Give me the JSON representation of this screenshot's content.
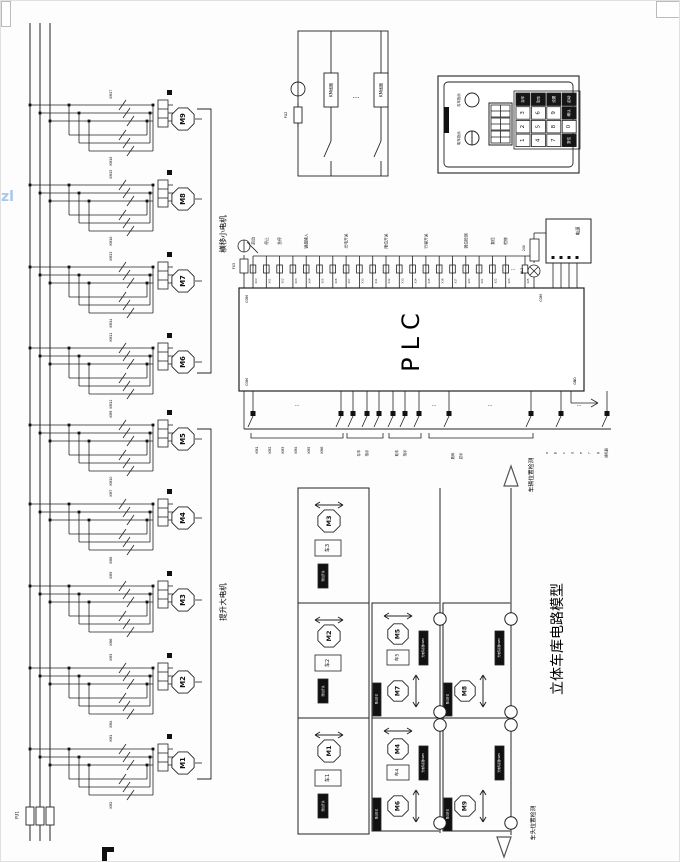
{
  "page": {
    "watermark": "zl"
  },
  "dots": "···",
  "power": {
    "fuse_main": "FU1"
  },
  "coil_box": {
    "fuse": "FU2",
    "lamp": "HL",
    "coil1": "KM线圈",
    "coil2": "KM线圈"
  },
  "panel": {
    "indicators": [
      {
        "label": "存车指示"
      },
      {
        "label": "取车指示"
      }
    ],
    "keys": [
      [
        "存车",
        "取车",
        "设置",
        "启动"
      ],
      [
        "3",
        "6",
        "9",
        "确认"
      ],
      [
        "2",
        "5",
        "8",
        "0"
      ],
      [
        "1",
        "4",
        "7",
        "复位"
      ]
    ]
  },
  "plc": {
    "label": "PLC",
    "com_tl": "COM",
    "com_tr": "COM",
    "com_bl": "COM",
    "gnd": "GND",
    "left_fuse": "FU3",
    "power_box": {
      "label": "电源",
      "rail_label": "24V",
      "lamp": "HL2"
    },
    "inputs": {
      "terminals": [
        "X00",
        "X01",
        "X02",
        "X03",
        "X04",
        "X05",
        "X06",
        "X07",
        "X10",
        "X11",
        "X12",
        "X13",
        "X14",
        "X15",
        "X16",
        "X17",
        "X20",
        "X21",
        "X22",
        "X23"
      ],
      "extra_terminal": "X25",
      "groups": [
        {
          "label": "启动",
          "at": 0
        },
        {
          "label": "停止",
          "at": 1
        },
        {
          "label": "急停",
          "at": 2
        },
        {
          "label": "键盘输入",
          "at": 4
        },
        {
          "label": "光电开关",
          "at": 7
        },
        {
          "label": "限位开关",
          "at": 10
        },
        {
          "label": "行程开关",
          "at": 13
        },
        {
          "label": "到位检测",
          "at": 16
        },
        {
          "label": "复位",
          "at": 18
        },
        {
          "label": "检修",
          "at": 19
        }
      ]
    },
    "outputs": {
      "coil_labels": [
        "KM1",
        "KM2",
        "KM3",
        "KM4",
        "KM5",
        "KM6"
      ],
      "group2": [
        "存车",
        "指示"
      ],
      "group3": [
        "取车",
        "指示"
      ],
      "group4": [
        "数码",
        "显示"
      ],
      "seg_labels": [
        "a",
        "b",
        "c",
        "d",
        "e",
        "f",
        "g",
        "蜂鸣器"
      ]
    }
  },
  "motor_section": {
    "branches": [
      {
        "name": "M1",
        "km_a": "KM1",
        "km_b": "KM2"
      },
      {
        "name": "M2",
        "km_a": "KM3",
        "km_b": "KM4"
      },
      {
        "name": "M3",
        "km_a": "KM5",
        "km_b": "KM6"
      },
      {
        "name": "M4",
        "km_a": "KM7",
        "km_b": "KM8"
      },
      {
        "name": "M5",
        "km_a": "KM9",
        "km_b": "KM10"
      },
      {
        "name": "M6",
        "km_a": "KM11",
        "km_b": "KM12"
      },
      {
        "name": "M7",
        "km_a": "KM13",
        "km_b": "KM14"
      },
      {
        "name": "M8",
        "km_a": "KM15",
        "km_b": "KM16"
      },
      {
        "name": "M9",
        "km_a": "KM17",
        "km_b": "KM18"
      }
    ],
    "groups": [
      {
        "label": "提升大电机"
      },
      {
        "label": "横移小电机"
      }
    ]
  },
  "garage": {
    "title": "立体车库电路模型",
    "sensor_top": "车辆位置检测",
    "sensor_bottom": "车头位置检测",
    "left_cells": [
      {
        "motor": "M3",
        "slot": "车3",
        "sensor": "限位开关"
      },
      {
        "motor": "M2",
        "slot": "车2",
        "sensor": "限位开关"
      },
      {
        "motor": "M1",
        "slot": "车1",
        "sensor": "限位开关"
      }
    ],
    "right_cells": [
      {
        "lift": "M5",
        "slot": "车5",
        "trav": "M7",
        "sensor_side": "光电传感器PWM",
        "sensor_left": "限位开关"
      },
      {
        "lift": "M4",
        "slot": "车4",
        "trav": "M6",
        "sensor_side": "光电传感器PWM",
        "sensor_left": "限位开关"
      },
      {
        "trav_only": "M8",
        "sensor_side": "光电传感器PWM",
        "sensor_left": "限位开关"
      },
      {
        "trav_only": "M9",
        "sensor_side": "光电传感器PWM",
        "sensor_left": "限位开关"
      }
    ]
  }
}
